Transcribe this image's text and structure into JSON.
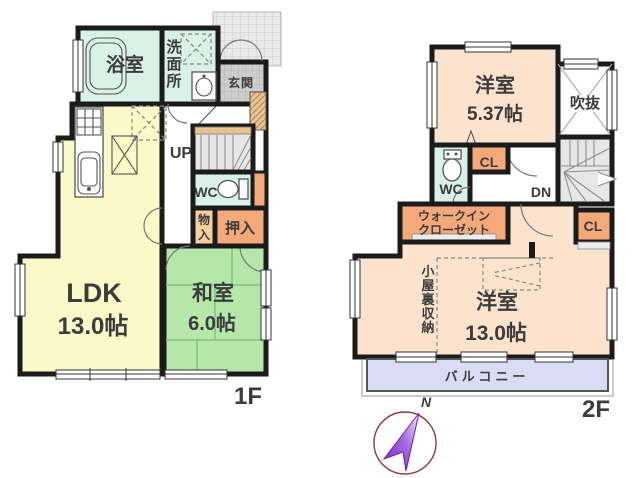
{
  "floor1": {
    "label": "1F",
    "bath_label": "浴室",
    "washroom_chars": [
      "洗",
      "面",
      "所"
    ],
    "entrance_label": "玄関",
    "up_label": "UP",
    "wc_label": "WC",
    "storage_chars": [
      "物",
      "入"
    ],
    "oshiire_label": "押入",
    "ldk_label": "LDK",
    "ldk_size": "13.0帖",
    "washitsu_label": "和室",
    "washitsu_size": "6.0帖"
  },
  "floor2": {
    "label": "2F",
    "bedroom_small_label": "洋室",
    "bedroom_small_size": "5.37帖",
    "void_label": "吹抜",
    "closet_upper_label": "CL",
    "wc_label": "WC",
    "down_label": "DN",
    "wic_line1": "ウォークイン",
    "wic_line2": "クローゼット",
    "closet_right_label": "CL",
    "attic_chars": [
      "小",
      "屋",
      "裏",
      "収",
      "納"
    ],
    "bedroom_large_label": "洋室",
    "bedroom_large_size": "13.0帖",
    "balcony_label": "バルコニー"
  },
  "compass": {
    "north_label": "N"
  },
  "colors": {
    "wall": "#1b1b1b",
    "wet_area": "#daf1e7",
    "ldk": "#fcf9c8",
    "tatami": "#b5e7aa",
    "tatami_line": "#82c382",
    "western_room": "#fbe3cd",
    "closet": "#f4a97b",
    "storage_light": "#f9cfa0",
    "balcony": "#d8dcf4",
    "stairs": "#e7e7e7",
    "entrance_tile": "#cdcdcd",
    "cabinet": "#e9c28f",
    "text": "#3c3c3c",
    "compass_needle": "#8a2be2",
    "north": "#d42222"
  }
}
